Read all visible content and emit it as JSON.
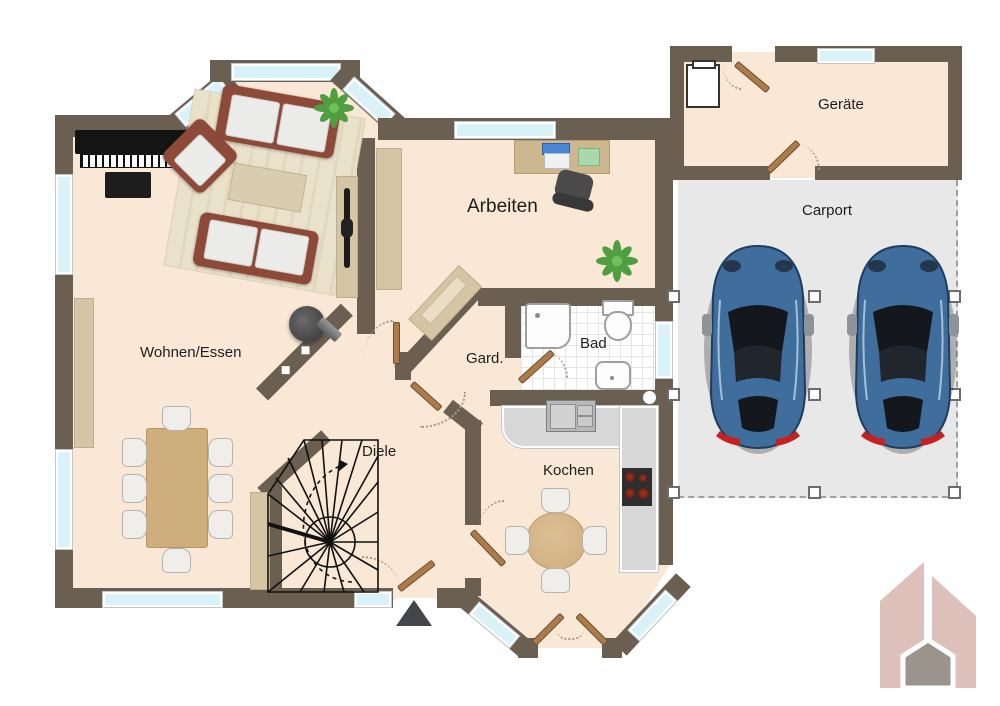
{
  "floorplan": {
    "rooms": {
      "living": {
        "label": "Wohnen/Essen"
      },
      "office": {
        "label": "Arbeiten"
      },
      "wardrobe": {
        "label": "Gard."
      },
      "bath": {
        "label": "Bad"
      },
      "hall": {
        "label": "Diele"
      },
      "kitchen": {
        "label": "Kochen"
      },
      "utility": {
        "label": "Geräte"
      },
      "carport": {
        "label": "Carport"
      }
    },
    "colors": {
      "wall": "#6b5f51",
      "floor": "#f9e8d5",
      "bath_floor": "#ffffff",
      "carport_floor": "#e8e8e8",
      "window_glass": "#d8f2f7",
      "kitchen_counter": "#d7d7d7",
      "wood_furniture": "#d5c5a5",
      "dining_table": "#cfae7e",
      "sofa_frame": "#8d4a38",
      "car_body": "#3f6e9d",
      "door_leaf": "#ad7b4a",
      "logo_rose": "#dcc0b9",
      "logo_gray": "#9b948c"
    },
    "furniture_icons": [
      "piano-icon",
      "sofa-icon",
      "armchair-icon",
      "coffee-table-icon",
      "rug-icon",
      "tv-lowboard-icon",
      "dining-table-icon",
      "dining-chair-icon",
      "sideboard-icon",
      "desk-icon",
      "laptop-icon",
      "office-chair-icon",
      "plant-icon",
      "wood-stove-icon",
      "wardrobe-cabinet-icon",
      "shower-icon",
      "toilet-icon",
      "washbasin-icon",
      "kitchen-sink-icon",
      "cooktop-icon",
      "round-table-icon",
      "washing-machine-icon",
      "spiral-stairs-icon",
      "car-icon",
      "entrance-arrow-icon",
      "house-logo-icon"
    ]
  }
}
